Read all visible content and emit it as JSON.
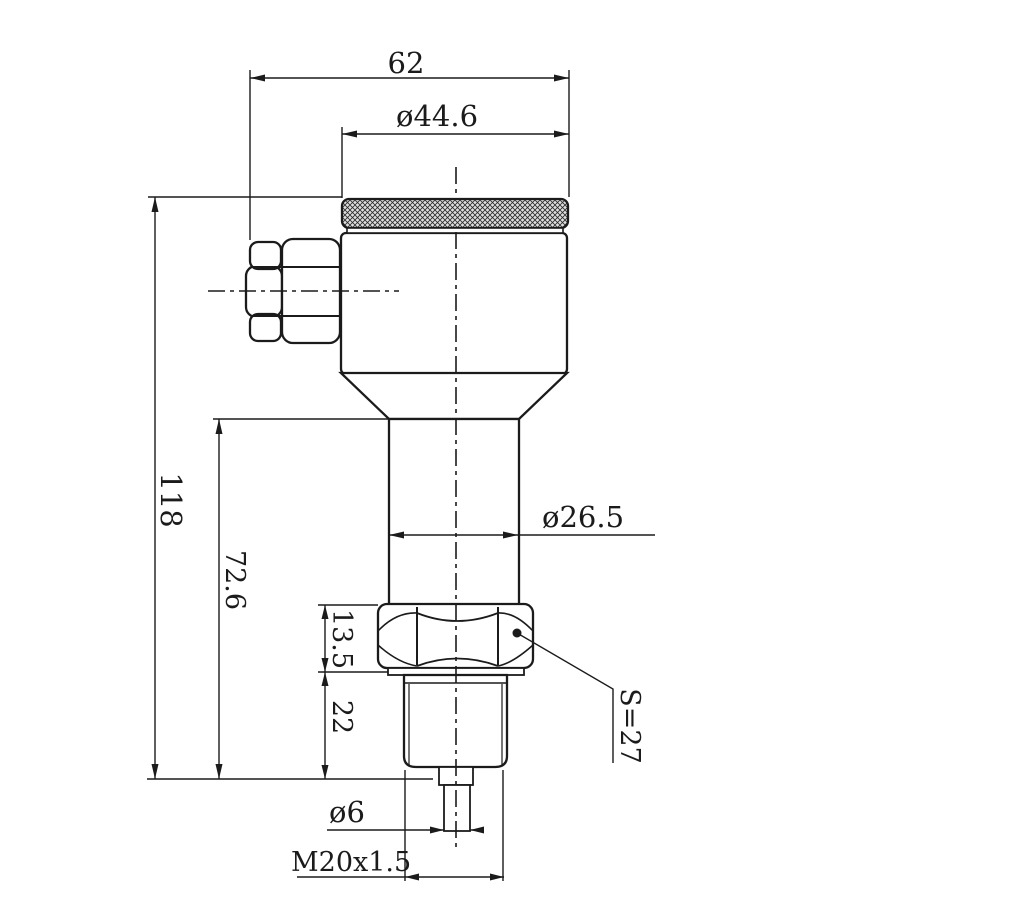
{
  "drawing": {
    "background": "#ffffff",
    "line_color": "#1b1b1b",
    "labels": {
      "width_overall": "62",
      "cap_diameter": "ø44.6",
      "height_overall": "118",
      "height_lower": "72.6",
      "body_diameter": "ø26.5",
      "hex_height": "13.5",
      "thread_length": "22",
      "hex_across_flats": "S=27",
      "probe_diameter": "ø6",
      "thread_spec": "M20x1.5"
    }
  }
}
